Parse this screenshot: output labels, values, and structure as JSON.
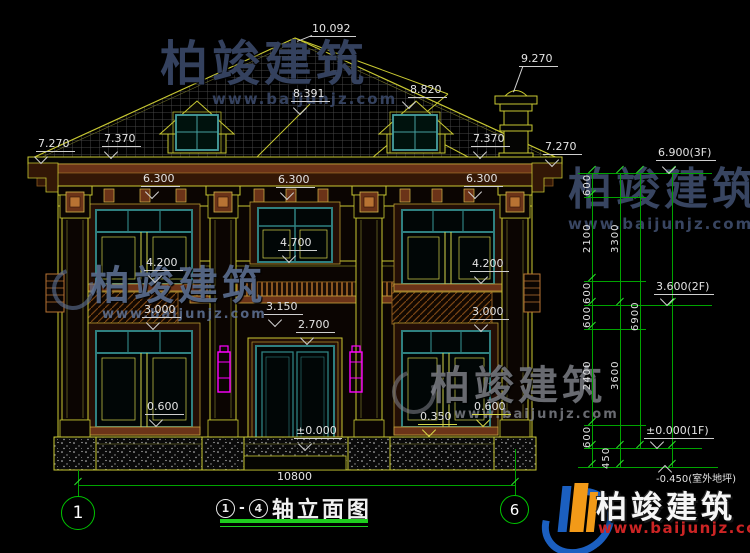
{
  "brand": {
    "name": "柏竣建筑",
    "url": "www.baijunjz.com"
  },
  "levels": {
    "ridge": "10.092",
    "chimney": "9.270",
    "back_ridge": "8.820",
    "back_ridge2": "8.391",
    "eave_l_outer": "7.270",
    "eave_l_inner": "7.370",
    "eave_r_inner": "7.370",
    "eave_r_outer": "7.270",
    "f2top_l": "6.300",
    "f2top_c": "6.300",
    "f2top_r": "6.300",
    "sill2_l": "4.200",
    "sill2_r": "4.200",
    "cwin": "4.700",
    "belt_l": "3.000",
    "belt_r": "3.000",
    "belt_c": "3.150",
    "door": "2.700",
    "sill1_l": "0.600",
    "sill1_r": "0.600",
    "sill1_r2": "0.350",
    "zero": "±0.000"
  },
  "chain": {
    "l3f": "6.900(3F)",
    "l2f": "3.600(2F)",
    "l1f": "±0.000(1F)",
    "lout": "-0.450(室外地坪)",
    "segs": [
      "600",
      "2100",
      "600",
      "600",
      "2400",
      "600",
      "450"
    ],
    "sub": [
      "3300",
      "3600"
    ],
    "total": "6900"
  },
  "bottom": {
    "width": "10800",
    "left_bubble": "1",
    "right_bubble": "6"
  },
  "title": {
    "bubble1": "1",
    "dash": "-",
    "bubble2": "4",
    "text": "轴立面图"
  }
}
